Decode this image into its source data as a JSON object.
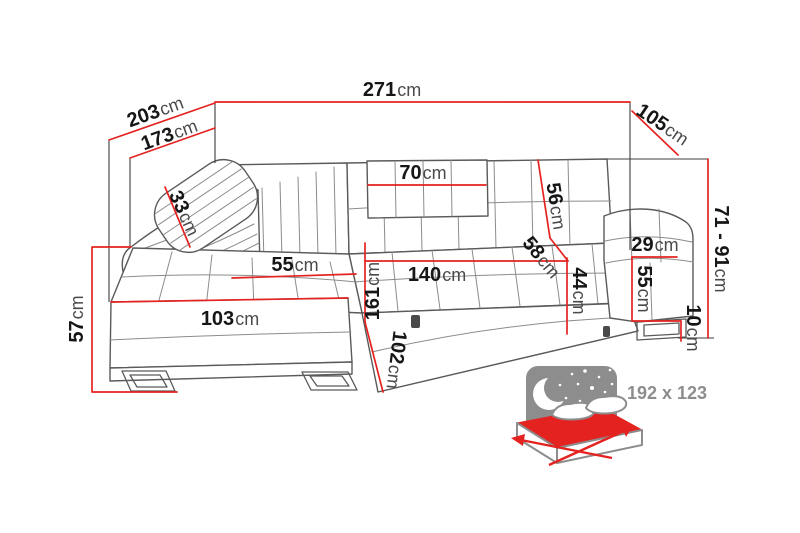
{
  "diagram": {
    "kind": "corner-sofa dimension diagram",
    "unit": "cm"
  },
  "dims": {
    "total_width": {
      "num": "271",
      "unit": "cm"
    },
    "depth_outer": {
      "num": "203",
      "unit": "cm"
    },
    "depth_inner": {
      "num": "173",
      "unit": "cm"
    },
    "side_depth": {
      "num": "105",
      "unit": "cm"
    },
    "headrest_width": {
      "num": "70",
      "unit": "cm"
    },
    "backrest_height": {
      "num": "56",
      "unit": "cm"
    },
    "seat_depth": {
      "num": "58",
      "unit": "cm"
    },
    "armrest_width": {
      "num": "29",
      "unit": "cm"
    },
    "armrest_height": {
      "num": "55",
      "unit": "cm"
    },
    "seat_height": {
      "num": "44",
      "unit": "cm"
    },
    "total_height": {
      "num": "71 - 91",
      "unit": "cm"
    },
    "leg_height": {
      "num": "10",
      "unit": "cm"
    },
    "chaise_length": {
      "num": "103",
      "unit": "cm"
    },
    "chaise_width": {
      "num": "55",
      "unit": "cm"
    },
    "seat_width": {
      "num": "140",
      "unit": "cm"
    },
    "bed_length": {
      "num": "161",
      "unit": "cm"
    },
    "bed_extension": {
      "num": "102",
      "unit": "cm"
    },
    "pillow_width": {
      "num": "33",
      "unit": "cm"
    },
    "base_height": {
      "num": "57",
      "unit": "cm"
    }
  },
  "sleeping_function": {
    "label": "192 x 123"
  },
  "colors": {
    "dimension_red": "#e42320",
    "sofa_line_gray": "#5a5a5a",
    "icon_gray": "#8d8d8d"
  }
}
